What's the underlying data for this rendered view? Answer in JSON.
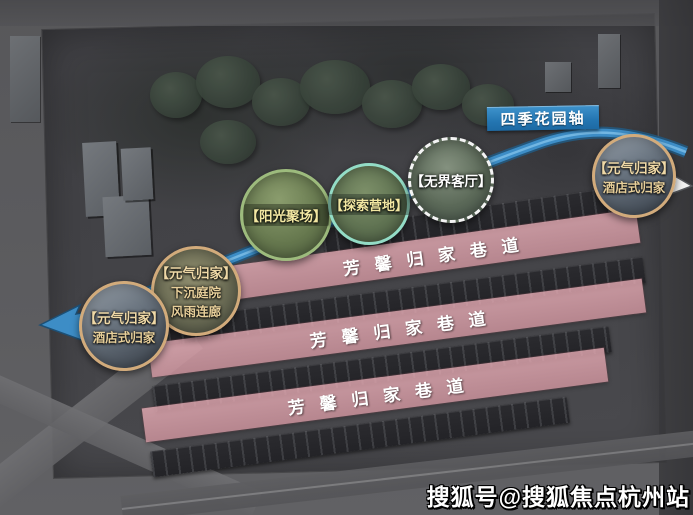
{
  "banner": {
    "label": "四季花园轴"
  },
  "lanes": {
    "items": [
      {
        "label": "芳馨归家巷道"
      },
      {
        "label": "芳馨归家巷道"
      },
      {
        "label": "芳馨归家巷道"
      }
    ]
  },
  "callouts": {
    "sunlight_plaza": {
      "label": "【阳光聚场】"
    },
    "explore_camp": {
      "label": "【探索营地】"
    },
    "boundless_living_room": {
      "label": "【无界客厅】"
    },
    "hotel_return_right": {
      "line1": "【元气归家】",
      "line2": "酒店式归家"
    },
    "sunken_courtyard": {
      "line1": "【元气归家】",
      "line2": "下沉庭院",
      "line3": "风雨连廊"
    },
    "hotel_return_left": {
      "line1": "【元气归家】",
      "line2": "酒店式归家"
    }
  },
  "watermark": {
    "text": "搜狐号@搜狐焦点杭州站"
  },
  "colors": {
    "axis_blue": "#3d8dc6",
    "banner_blue": "#2476b2",
    "lane_pink": "#dfa6b0",
    "tan_border": "#d2ab7b",
    "green_border": "#9dbb7d",
    "teal_border": "#93dcc6"
  }
}
